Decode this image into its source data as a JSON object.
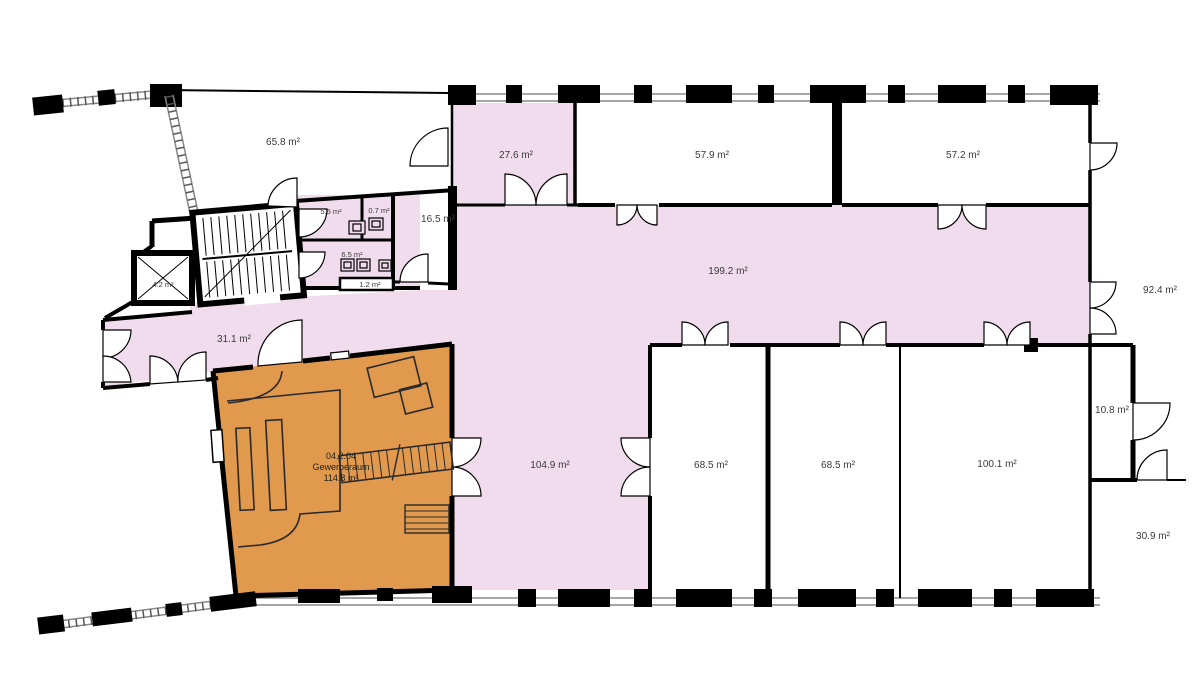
{
  "plan": {
    "colors": {
      "pink": "#f1dced",
      "orange": "#e0994d",
      "wall": "#000000",
      "line": "#2a2a2a"
    },
    "rooms": {
      "r65": "65.8 m²",
      "r27": "27.6 m²",
      "r579": "57.9 m²",
      "r572": "57.2 m²",
      "r924": "92.4 m²",
      "r165": "16.5 m²",
      "r55": "5.5 m²",
      "r07": "0.7 m²",
      "r65b": "6.5 m²",
      "r12": "1.2 m²",
      "r42": "4.2 m²",
      "r199": "199.2 m²",
      "r311": "31.1 m²",
      "r1049": "104.9 m²",
      "r685a": "68.5 m²",
      "r685b": "68.5 m²",
      "r1001": "100.1 m²",
      "r108": "10.8 m²",
      "r309": "30.9 m²"
    },
    "unit": {
      "number": "04.2.04",
      "name": "Gewerberaum",
      "area": "114.8 m²"
    }
  }
}
